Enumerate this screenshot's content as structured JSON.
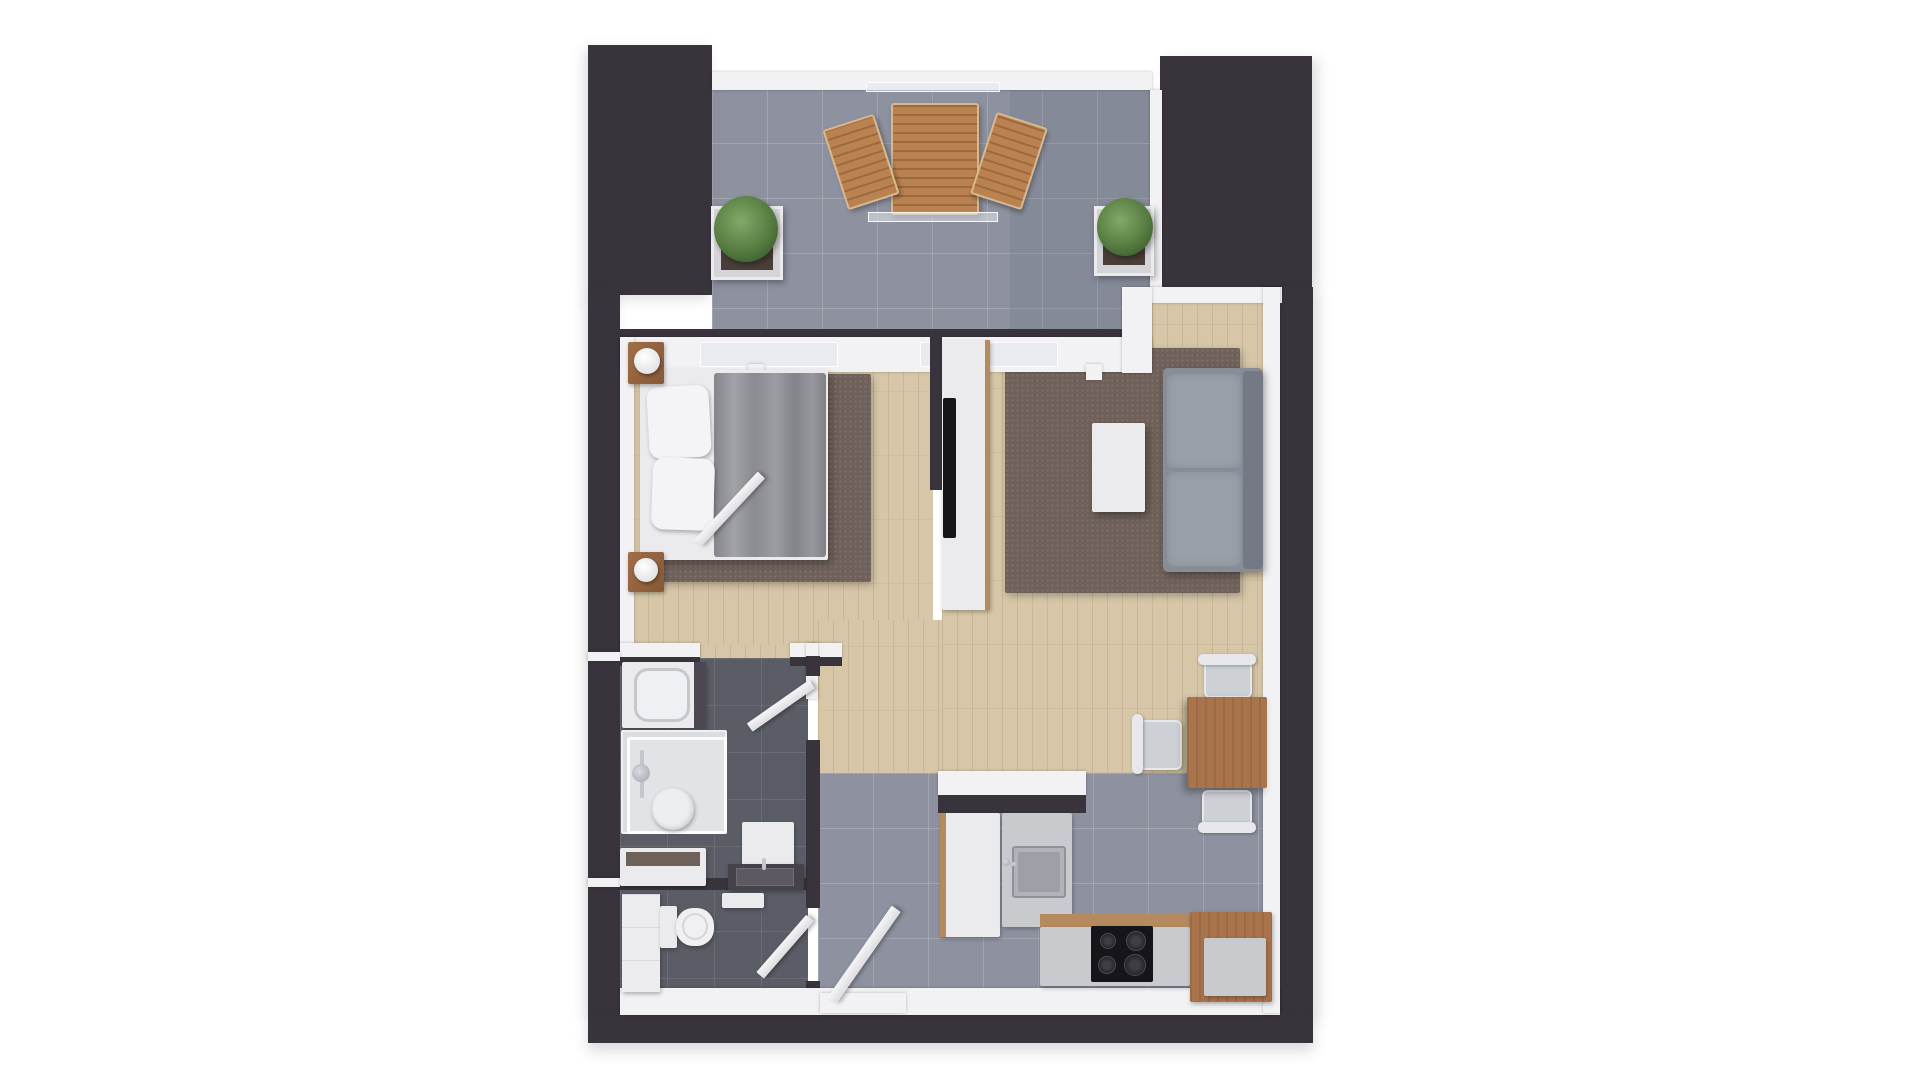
{
  "meta": {
    "title": "3D rendered top-down floor plan of a one-bedroom apartment with balcony",
    "render_style": "photoreal architectural top view, no text labels",
    "rooms": [
      "balcony",
      "bedroom",
      "living-room",
      "dining-area",
      "kitchen",
      "hallway",
      "bathroom",
      "wc"
    ]
  },
  "palette": {
    "background": "#ffffff",
    "wall_dark": "#39343c",
    "wall_white": "#f2f1f3",
    "wood_floor": "#d7c7a8",
    "tile_gray": "#8e92a0",
    "tile_dark": "#5b5d66",
    "rug_brown": "#6f6159",
    "sofa_gray": "#878d97",
    "furniture_wood": "#a9744c",
    "plant_green": "#567c41",
    "appliance_black": "#16161a"
  },
  "scene": {
    "canvas": {
      "w": 1920,
      "h": 1080,
      "bg": "#ffffff"
    },
    "elements": [
      {
        "name": "living-dining-floor",
        "cls": "wood",
        "x": 942,
        "y": 301,
        "w": 323,
        "h": 472
      },
      {
        "name": "bedroom-floor",
        "cls": "wood",
        "x": 633,
        "y": 372,
        "w": 300,
        "h": 276
      },
      {
        "name": "hallway-floor-wood",
        "cls": "wood",
        "x": 818,
        "y": 620,
        "w": 124,
        "h": 155
      },
      {
        "name": "bedroom-doorway-floor",
        "cls": "wood",
        "x": 700,
        "y": 645,
        "w": 90,
        "h": 24
      },
      {
        "name": "balcony-floor",
        "cls": "tile",
        "x": 712,
        "y": 88,
        "w": 440,
        "h": 247
      },
      {
        "name": "balcony-floor-shade",
        "x": 1010,
        "y": 88,
        "w": 142,
        "h": 247,
        "bg": "rgba(60,66,88,0.10)"
      },
      {
        "name": "hall-kitchen-floor",
        "cls": "tile",
        "x": 818,
        "y": 773,
        "w": 447,
        "h": 217
      },
      {
        "name": "bathroom-floor",
        "cls": "tiled",
        "x": 620,
        "y": 658,
        "w": 188,
        "h": 226
      },
      {
        "name": "wc-floor",
        "cls": "tiled",
        "x": 620,
        "y": 884,
        "w": 188,
        "h": 106
      },
      {
        "name": "bedroom-rug",
        "cls": "rug",
        "x": 653,
        "y": 374,
        "w": 218,
        "h": 208
      },
      {
        "name": "living-rug",
        "cls": "rug",
        "x": 1005,
        "y": 348,
        "w": 235,
        "h": 245
      },
      {
        "name": "wall-block-top-left",
        "cls": "dark",
        "x": 588,
        "y": 45,
        "w": 124,
        "h": 250,
        "shadow": "-4px 4px 12px rgba(70,70,85,0.18)"
      },
      {
        "name": "wall-block-top-right",
        "cls": "dark",
        "x": 1160,
        "y": 56,
        "w": 152,
        "h": 231,
        "shadow": "6px 4px 12px rgba(70,70,85,0.18)"
      },
      {
        "name": "wall-left-outer",
        "cls": "dark",
        "x": 588,
        "y": 293,
        "w": 32,
        "h": 722,
        "shadow": "-4px 4px 12px rgba(70,70,85,0.18)"
      },
      {
        "name": "wall-right-outer",
        "cls": "dark",
        "x": 1280,
        "y": 287,
        "w": 33,
        "h": 728,
        "shadow": "6px 6px 12px rgba(70,70,85,0.18)"
      },
      {
        "name": "wall-bottom-outer",
        "cls": "dark",
        "x": 588,
        "y": 1013,
        "w": 725,
        "h": 30,
        "shadow": "0 8px 14px rgba(70,70,85,0.2)"
      },
      {
        "name": "balcony-railing",
        "cls": "wallw",
        "x": 712,
        "y": 72,
        "w": 440,
        "h": 18
      },
      {
        "name": "balcony-glass-screen-top",
        "cls": "glass",
        "x": 866,
        "y": 82,
        "w": 134,
        "h": 10
      },
      {
        "name": "balcony-wall-core",
        "cls": "darkline",
        "x": 620,
        "y": 329,
        "w": 532,
        "h": 9
      },
      {
        "name": "balcony-wall",
        "cls": "wallw",
        "x": 620,
        "y": 337,
        "w": 532,
        "h": 35
      },
      {
        "name": "balcony-door-glass-left",
        "cls": "glass",
        "x": 700,
        "y": 342,
        "w": 138,
        "h": 25
      },
      {
        "name": "balcony-door-glass-right",
        "cls": "glass",
        "x": 920,
        "y": 342,
        "w": 138,
        "h": 25
      },
      {
        "name": "door-tab-1",
        "cls": "wallw",
        "x": 748,
        "y": 364,
        "w": 16,
        "h": 16
      },
      {
        "name": "door-tab-2",
        "cls": "wallw",
        "x": 950,
        "y": 364,
        "w": 16,
        "h": 16
      },
      {
        "name": "door-tab-3",
        "cls": "wallw",
        "x": 1086,
        "y": 364,
        "w": 16,
        "h": 16
      },
      {
        "name": "tr-block-trim-left",
        "cls": "wallw",
        "x": 1150,
        "y": 90,
        "w": 12,
        "h": 197
      },
      {
        "name": "living-top-wall",
        "cls": "wallw",
        "x": 1150,
        "y": 287,
        "w": 132,
        "h": 16
      },
      {
        "name": "balcony-step-wall",
        "cls": "wallw",
        "x": 1122,
        "y": 287,
        "w": 30,
        "h": 86
      },
      {
        "name": "bedroom-left-wall",
        "cls": "wallw",
        "x": 620,
        "y": 337,
        "w": 14,
        "h": 312
      },
      {
        "name": "bedroom-bottom-wall-left",
        "cls": "wallw",
        "x": 620,
        "y": 643,
        "w": 80,
        "h": 15
      },
      {
        "name": "bedroom-bottom-wall-right",
        "cls": "wallw",
        "x": 790,
        "y": 643,
        "w": 52,
        "h": 15
      },
      {
        "name": "bedroom-bottom-wall-core-left",
        "cls": "darkline",
        "x": 620,
        "y": 657,
        "w": 80,
        "h": 9
      },
      {
        "name": "bedroom-bottom-wall-core-right",
        "cls": "darkline",
        "x": 790,
        "y": 657,
        "w": 52,
        "h": 9
      },
      {
        "name": "hall-corner-wall",
        "cls": "wallw",
        "x": 806,
        "y": 643,
        "w": 12,
        "h": 56
      },
      {
        "name": "bath-wall-segment-top",
        "cls": "darkline",
        "x": 806,
        "y": 656,
        "w": 14,
        "h": 20
      },
      {
        "name": "bath-wall-segment-mid",
        "cls": "darkline",
        "x": 806,
        "y": 740,
        "w": 14,
        "h": 168
      },
      {
        "name": "bath-wall-segment-bottom",
        "cls": "darkline",
        "x": 806,
        "y": 981,
        "w": 14,
        "h": 34
      },
      {
        "name": "bath-wc-divider",
        "cls": "darkline",
        "x": 620,
        "y": 878,
        "w": 186,
        "h": 12
      },
      {
        "name": "left-wall-junction-1",
        "cls": "wallw",
        "x": 588,
        "y": 652,
        "w": 32,
        "h": 9
      },
      {
        "name": "left-wall-junction-2",
        "cls": "wallw",
        "x": 588,
        "y": 878,
        "w": 32,
        "h": 9
      },
      {
        "name": "tv-partition-wall",
        "cls": "darkline",
        "x": 930,
        "y": 333,
        "w": 12,
        "h": 157
      },
      {
        "name": "kitchen-divider-counter",
        "cls": "wallw",
        "x": 938,
        "y": 771,
        "w": 148,
        "h": 24
      },
      {
        "name": "kitchen-divider-core",
        "cls": "darkline",
        "x": 938,
        "y": 795,
        "w": 148,
        "h": 18
      },
      {
        "name": "bottom-inner-wall",
        "cls": "wallw",
        "x": 620,
        "y": 988,
        "w": 660,
        "h": 27
      },
      {
        "name": "right-inner-wall",
        "cls": "wallw",
        "x": 1263,
        "y": 287,
        "w": 17,
        "h": 726
      },
      {
        "name": "balcony-table",
        "cls": "slats",
        "x": 891,
        "y": 103,
        "w": 88,
        "h": 112,
        "shadow": "2px 3px 6px rgba(0,0,0,0.3)"
      },
      {
        "name": "balcony-glass-screen-bottom",
        "cls": "glass",
        "x": 868,
        "y": 212,
        "w": 130,
        "h": 10
      },
      {
        "name": "balcony-chair-left",
        "cls": "slats",
        "x": 834,
        "y": 120,
        "w": 54,
        "h": 84,
        "rot": -18,
        "shadow": "2px 3px 5px rgba(0,0,0,0.3)"
      },
      {
        "name": "balcony-chair-right",
        "cls": "slats",
        "x": 982,
        "y": 118,
        "w": 54,
        "h": 86,
        "rot": 18,
        "shadow": "2px 3px 5px rgba(0,0,0,0.3)"
      },
      {
        "name": "planter-left",
        "cls": "pot",
        "x": 711,
        "y": 206,
        "w": 72,
        "h": 74
      },
      {
        "name": "planter-left-soil",
        "cls": "soil",
        "x": 721,
        "y": 216,
        "w": 52,
        "h": 54
      },
      {
        "name": "plant-left",
        "cls": "plant",
        "x": 714,
        "y": 196,
        "w": 64,
        "h": 66
      },
      {
        "name": "planter-right",
        "cls": "pot",
        "x": 1094,
        "y": 206,
        "w": 60,
        "h": 70
      },
      {
        "name": "planter-right-soil",
        "cls": "soil",
        "x": 1103,
        "y": 215,
        "w": 42,
        "h": 50
      },
      {
        "name": "plant-right",
        "cls": "plant",
        "x": 1097,
        "y": 198,
        "w": 56,
        "h": 58
      },
      {
        "name": "bed-frame",
        "cls": "white",
        "x": 640,
        "y": 370,
        "w": 188,
        "h": 190,
        "shadow": "3px 4px 8px rgba(0,0,0,0.3)"
      },
      {
        "name": "bed-duvet",
        "cls": "duvet",
        "x": 714,
        "y": 373,
        "w": 112,
        "h": 184
      },
      {
        "name": "bed-pillow-1",
        "cls": "pillow",
        "x": 648,
        "y": 386,
        "w": 62,
        "h": 72,
        "rot": -3
      },
      {
        "name": "bed-pillow-2",
        "cls": "pillow",
        "x": 652,
        "y": 458,
        "w": 62,
        "h": 72,
        "rot": 2
      },
      {
        "name": "nightstand-head",
        "cls": "woodf",
        "x": 628,
        "y": 342,
        "w": 36,
        "h": 42
      },
      {
        "name": "lamp-head",
        "cls": "lamp",
        "x": 634,
        "y": 348,
        "w": 26,
        "h": 26
      },
      {
        "name": "nightstand-foot",
        "cls": "woodf",
        "x": 628,
        "y": 552,
        "w": 36,
        "h": 40
      },
      {
        "name": "lamp-foot",
        "cls": "lamp",
        "x": 634,
        "y": 558,
        "w": 24,
        "h": 24
      },
      {
        "name": "bedroom-door",
        "cls": "doorleaf",
        "x": 698,
        "y": 538,
        "w": 93,
        "h": 10,
        "rot": -47,
        "origin": "left"
      },
      {
        "name": "tv-cabinet",
        "cls": "white",
        "x": 942,
        "y": 340,
        "w": 48,
        "h": 270
      },
      {
        "name": "tv-cabinet-edge",
        "cls": "woodedge",
        "x": 985,
        "y": 340,
        "w": 5,
        "h": 270
      },
      {
        "name": "tv",
        "cls": "black",
        "x": 943,
        "y": 398,
        "w": 13,
        "h": 140
      },
      {
        "name": "sofa-base",
        "cls": "sofa",
        "x": 1163,
        "y": 368,
        "w": 100,
        "h": 204
      },
      {
        "name": "sofa-cushion-1",
        "cls": "cushion",
        "x": 1167,
        "y": 374,
        "w": 74,
        "h": 94
      },
      {
        "name": "sofa-cushion-2",
        "cls": "cushion",
        "x": 1167,
        "y": 472,
        "w": 74,
        "h": 94
      },
      {
        "name": "sofa-back",
        "cls": "sofaback",
        "x": 1243,
        "y": 371,
        "w": 20,
        "h": 198
      },
      {
        "name": "coffee-table",
        "cls": "white",
        "x": 1092,
        "y": 423,
        "w": 53,
        "h": 89,
        "shadow": "3px 4px 8px rgba(0,0,0,0.35)"
      },
      {
        "name": "dining-chair-top-seat",
        "cls": "seat",
        "x": 1204,
        "y": 660,
        "w": 48,
        "h": 38
      },
      {
        "name": "dining-chair-top-back",
        "cls": "chairback",
        "x": 1198,
        "y": 654,
        "w": 58,
        "h": 11
      },
      {
        "name": "dining-chair-left-seat",
        "cls": "seat",
        "x": 1140,
        "y": 720,
        "w": 42,
        "h": 50
      },
      {
        "name": "dining-chair-left-back",
        "cls": "chairback",
        "x": 1132,
        "y": 714,
        "w": 11,
        "h": 60
      },
      {
        "name": "dining-chair-bottom-seat",
        "cls": "seat",
        "x": 1202,
        "y": 790,
        "w": 50,
        "h": 36
      },
      {
        "name": "dining-table",
        "cls": "woodgrain",
        "x": 1187,
        "y": 697,
        "w": 80,
        "h": 91,
        "shadow": "-3px 4px 8px rgba(0,0,0,0.35)"
      },
      {
        "name": "dining-chair-bottom-back",
        "cls": "chairback",
        "x": 1198,
        "y": 822,
        "w": 58,
        "h": 11
      },
      {
        "name": "washing-machine",
        "cls": "white",
        "x": 622,
        "y": 662,
        "w": 84,
        "h": 66
      },
      {
        "name": "washing-machine-drum",
        "cls": "drum",
        "x": 634,
        "y": 668,
        "w": 56,
        "h": 54
      },
      {
        "name": "washing-machine-panel",
        "cls": "darkpanel",
        "x": 694,
        "y": 662,
        "w": 12,
        "h": 66
      },
      {
        "name": "shower-tray",
        "cls": "tray",
        "x": 621,
        "y": 730,
        "w": 106,
        "h": 104
      },
      {
        "name": "shower-glass",
        "cls": "glass2",
        "x": 627,
        "y": 737,
        "w": 100,
        "h": 97
      },
      {
        "name": "shower-rail",
        "cls": "metal",
        "x": 640,
        "y": 750,
        "w": 4,
        "h": 48
      },
      {
        "name": "shower-head",
        "cls": "metaldot",
        "x": 632,
        "y": 764,
        "w": 18,
        "h": 18
      },
      {
        "name": "shower-drain",
        "cls": "drain",
        "x": 652,
        "y": 788,
        "w": 42,
        "h": 42
      },
      {
        "name": "bath-shelf",
        "cls": "white",
        "x": 620,
        "y": 848,
        "w": 86,
        "h": 38
      },
      {
        "name": "bath-shelf-inner",
        "cls": "shelfwood",
        "x": 626,
        "y": 852,
        "w": 74,
        "h": 14
      },
      {
        "name": "vanity-mirror",
        "cls": "white",
        "x": 742,
        "y": 822,
        "w": 52,
        "h": 46
      },
      {
        "name": "vanity-counter",
        "cls": "darkcounter",
        "x": 728,
        "y": 864,
        "w": 76,
        "h": 26
      },
      {
        "name": "vanity-basin",
        "cls": "basin",
        "x": 736,
        "y": 868,
        "w": 58,
        "h": 18
      },
      {
        "name": "vanity-faucet",
        "cls": "metal",
        "x": 762,
        "y": 858,
        "w": 4,
        "h": 12
      },
      {
        "name": "bathroom-door",
        "cls": "doorleaf",
        "x": 736,
        "y": 679,
        "w": 76,
        "h": 10,
        "rot": -35,
        "origin": "right"
      },
      {
        "name": "wc-cabinet",
        "cls": "cab",
        "x": 622,
        "y": 894,
        "w": 38,
        "h": 98
      },
      {
        "name": "toilet-tank",
        "cls": "white",
        "x": 660,
        "y": 906,
        "w": 17,
        "h": 42
      },
      {
        "name": "toilet-bowl",
        "cls": "bowl",
        "x": 676,
        "y": 908,
        "w": 38,
        "h": 38
      },
      {
        "name": "toilet-seat-ring",
        "cls": "ring",
        "x": 682,
        "y": 913,
        "w": 26,
        "h": 27
      },
      {
        "name": "wc-shelf",
        "cls": "white",
        "x": 722,
        "y": 893,
        "w": 42,
        "h": 15
      },
      {
        "name": "wc-door",
        "cls": "doorleaf",
        "x": 734,
        "y": 913,
        "w": 76,
        "h": 10,
        "rot": -49,
        "origin": "right"
      },
      {
        "name": "fridge",
        "cls": "white",
        "x": 940,
        "y": 813,
        "w": 60,
        "h": 124
      },
      {
        "name": "fridge-edge",
        "cls": "woodedge",
        "x": 940,
        "y": 813,
        "w": 6,
        "h": 124
      },
      {
        "name": "kitchen-sink-counter",
        "cls": "counter",
        "x": 1002,
        "y": 813,
        "w": 70,
        "h": 114
      },
      {
        "name": "kitchen-sink",
        "cls": "ksink",
        "x": 1012,
        "y": 846,
        "w": 54,
        "h": 52
      },
      {
        "name": "kitchen-sink-basin",
        "cls": "ksinkin",
        "x": 1018,
        "y": 852,
        "w": 42,
        "h": 40
      },
      {
        "name": "kitchen-faucet",
        "cls": "metal",
        "x": 1004,
        "y": 862,
        "w": 12,
        "h": 4
      },
      {
        "name": "kitchen-faucet-base",
        "cls": "metaldot",
        "x": 1002,
        "y": 858,
        "w": 8,
        "h": 8
      },
      {
        "name": "kitchen-counter-edge",
        "cls": "woodedge",
        "x": 1040,
        "y": 914,
        "w": 232,
        "h": 13
      },
      {
        "name": "kitchen-counter",
        "cls": "counter",
        "x": 1040,
        "y": 927,
        "w": 150,
        "h": 59
      },
      {
        "name": "cooktop",
        "cls": "black",
        "x": 1091,
        "y": 926,
        "w": 62,
        "h": 56
      },
      {
        "name": "cooktop-burner-1",
        "cls": "burner",
        "x": 1100,
        "y": 933,
        "w": 16,
        "h": 16
      },
      {
        "name": "cooktop-burner-2",
        "cls": "burner",
        "x": 1126,
        "y": 931,
        "w": 20,
        "h": 20
      },
      {
        "name": "cooktop-burner-3",
        "cls": "burner",
        "x": 1098,
        "y": 956,
        "w": 18,
        "h": 18
      },
      {
        "name": "cooktop-burner-4",
        "cls": "burner",
        "x": 1124,
        "y": 954,
        "w": 22,
        "h": 22
      },
      {
        "name": "kitchen-island-cabinet",
        "cls": "woodgrain",
        "x": 1190,
        "y": 912,
        "w": 82,
        "h": 90
      },
      {
        "name": "kitchen-island-top",
        "cls": "counter",
        "x": 1204,
        "y": 938,
        "w": 62,
        "h": 58
      },
      {
        "name": "entrance-threshold",
        "cls": "wallw",
        "x": 820,
        "y": 993,
        "w": 86,
        "h": 20
      },
      {
        "name": "entrance-door",
        "cls": "doorleaf",
        "x": 832,
        "y": 995,
        "w": 112,
        "h": 11,
        "rot": -55,
        "origin": "left"
      }
    ]
  }
}
